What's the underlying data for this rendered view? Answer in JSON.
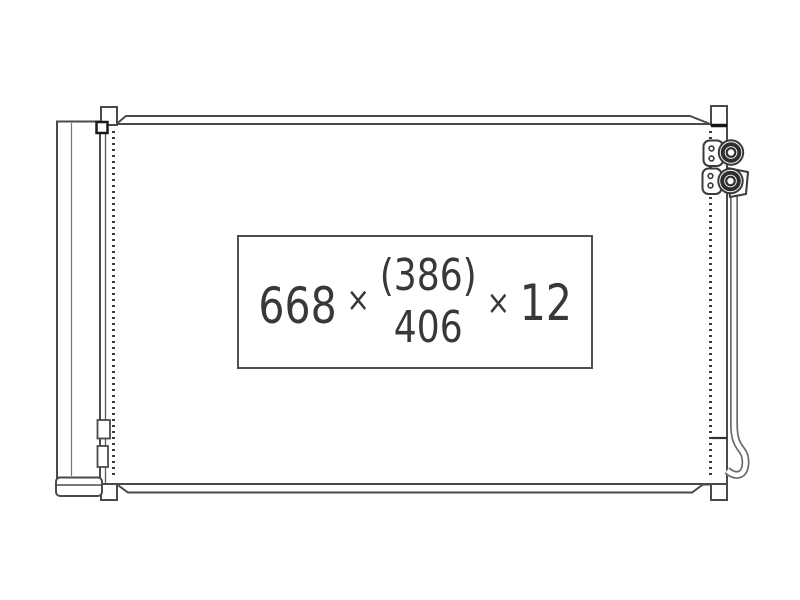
{
  "canvas": {
    "background": "#ffffff",
    "line_color": "#4a4a4a",
    "pipe_color": "#6a6a6a"
  },
  "dimension_label": {
    "width": "668",
    "times_1": "×",
    "height_paren": "(386)",
    "height": "406",
    "times_2": "×",
    "thickness": "12",
    "text_color": "#383838",
    "box_border_color": "#4f4f4f"
  }
}
